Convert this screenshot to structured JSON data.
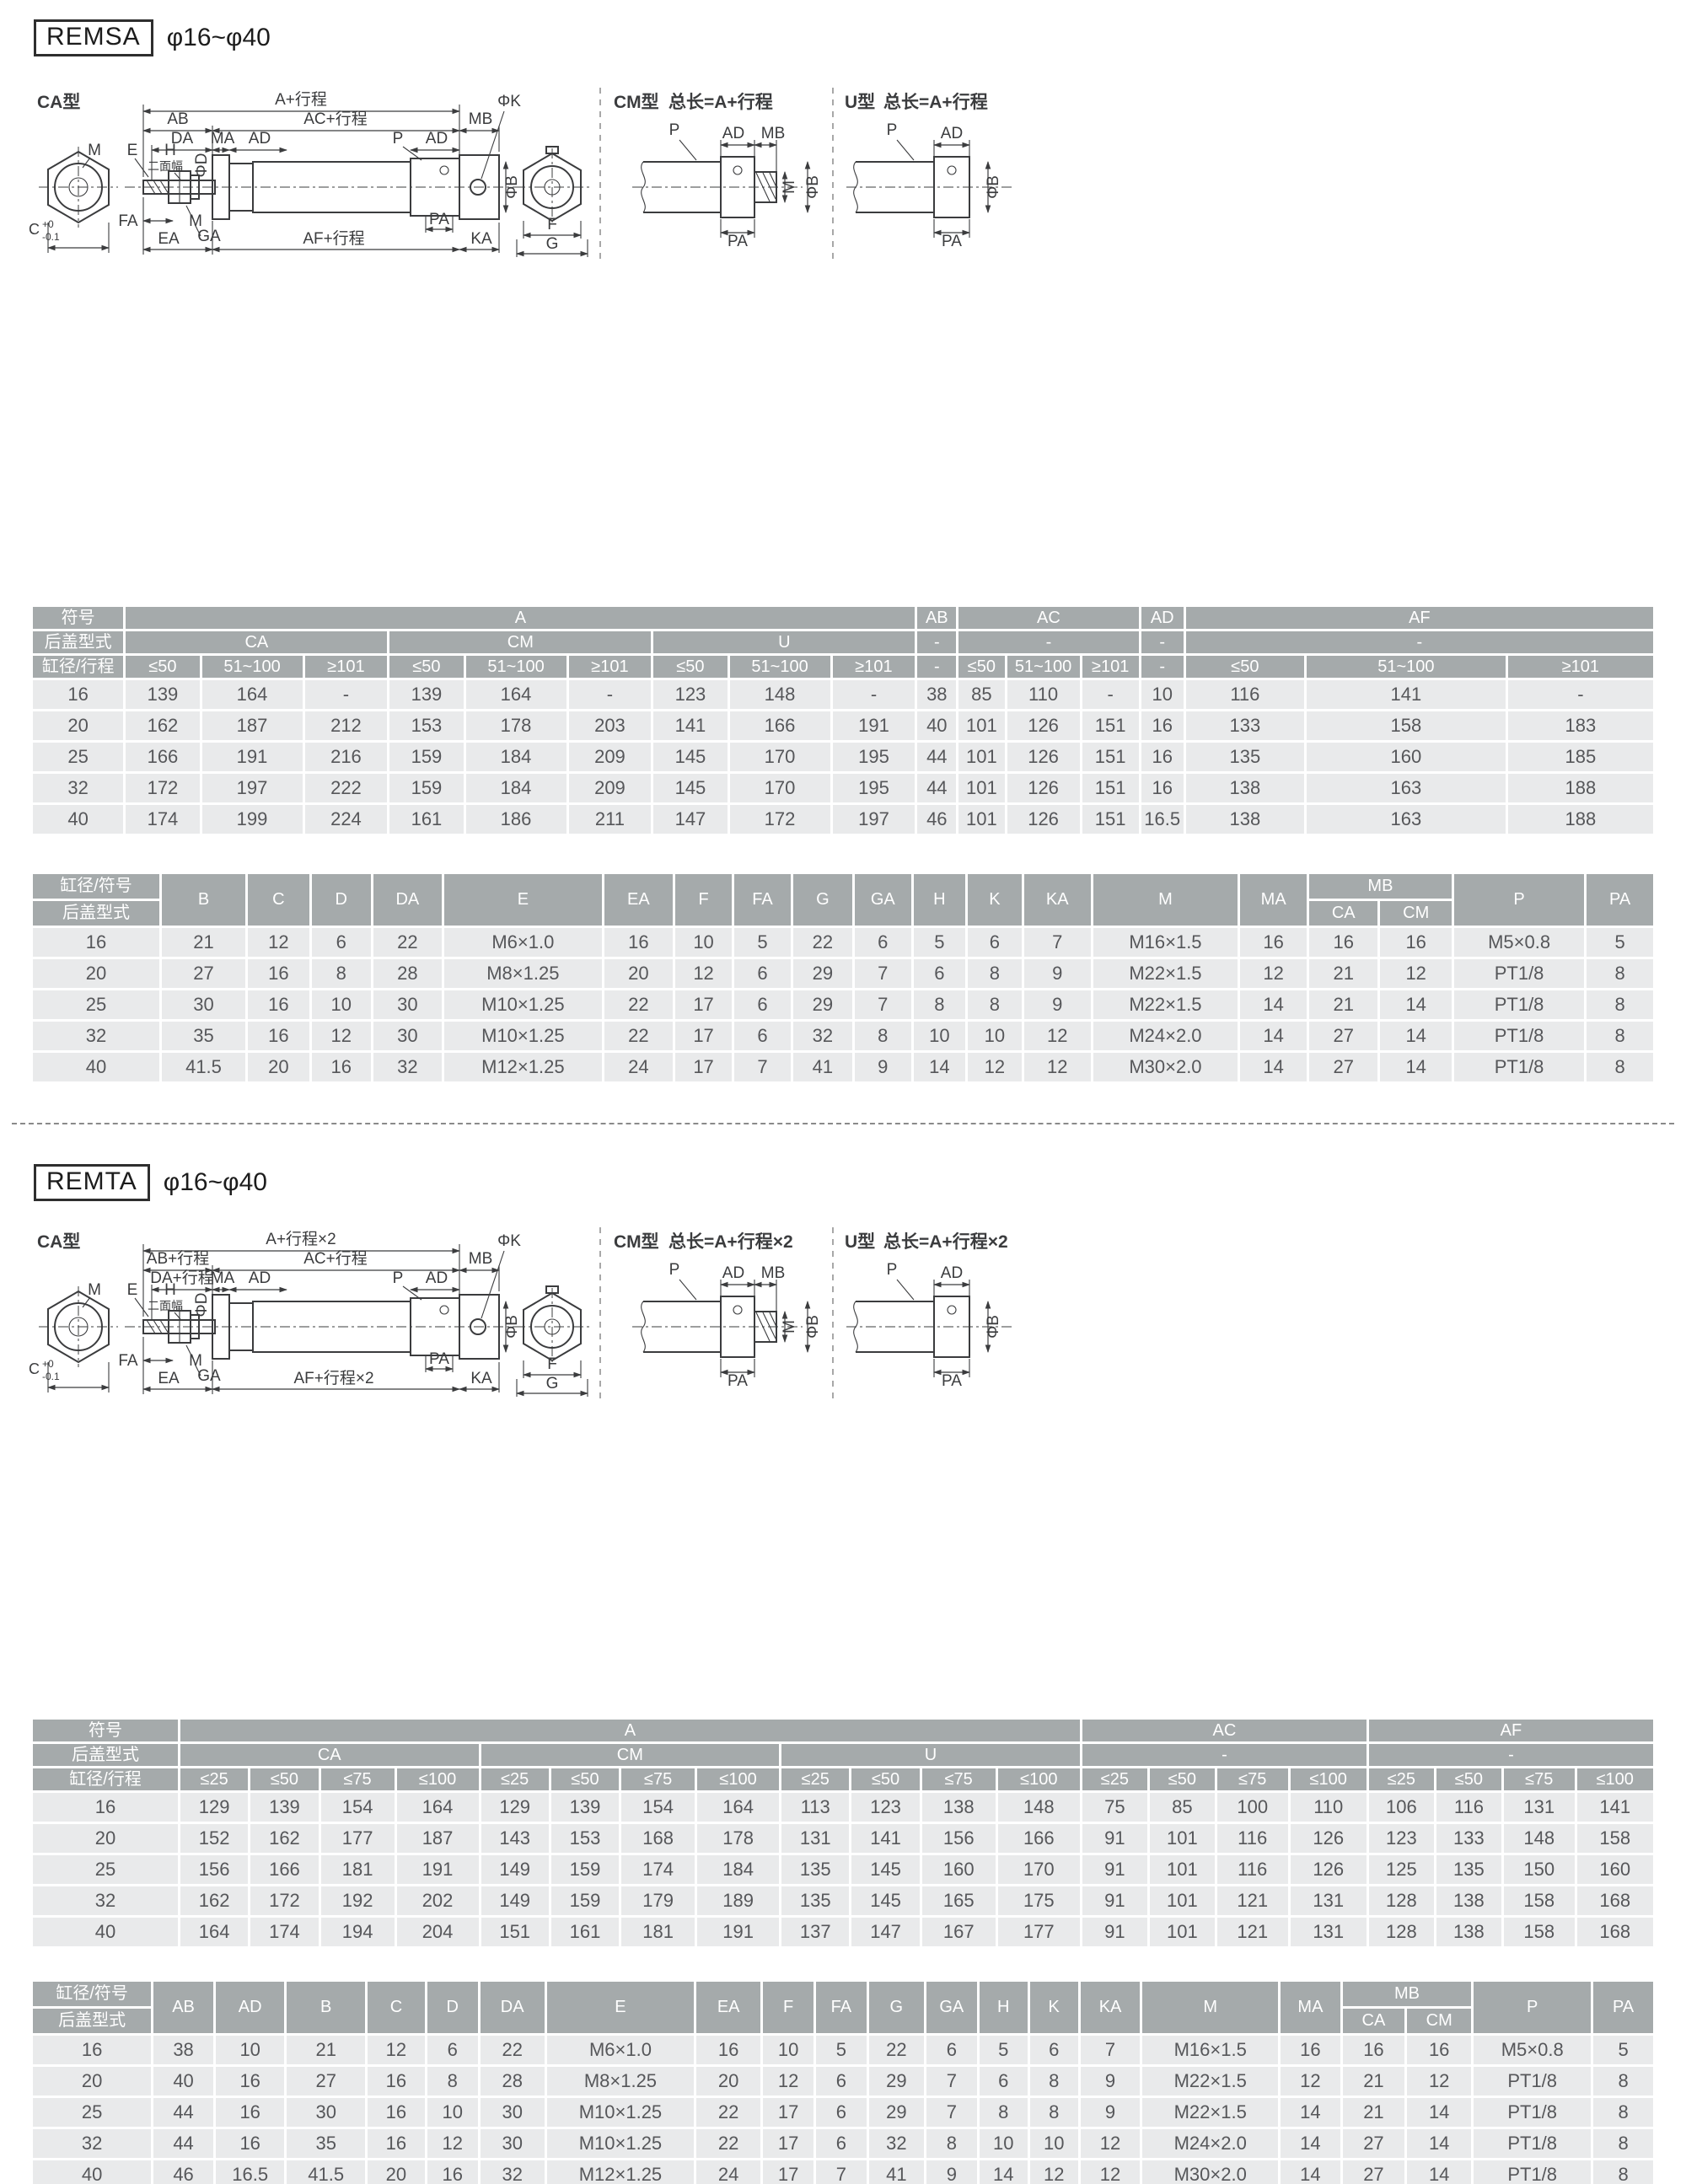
{
  "colors": {
    "header_bg": "#a5aaab",
    "row_bg": "#e9eaeb",
    "header_text": "#ffffff",
    "body_text": "#56575a",
    "line": "#3b3c3e"
  },
  "sections": [
    {
      "id": "remsa",
      "badge": "REMSA",
      "range": "φ16~φ40",
      "drawing": {
        "ca_title": "CA型",
        "cm_title": "CM型",
        "u_title": "U型",
        "cm_total": "总长=A+行程",
        "u_total": "总长=A+行程",
        "labels": {
          "a": "A+行程",
          "ab": "AB",
          "ac": "AC+行程",
          "mb": "MB",
          "phik": "ΦK",
          "da": "DA",
          "ma": "MA",
          "ad1": "AD",
          "p": "P",
          "ad2": "AD",
          "m_front": "M",
          "e": "E",
          "h": "H",
          "flats": "二面幅",
          "phid": "ΦD",
          "fa": "FA",
          "m_rod": "M",
          "ga": "GA",
          "ea": "EA",
          "af": "AF+行程",
          "pa": "PA",
          "ka": "KA",
          "phib": "ΦB",
          "c": "C",
          "c_sup": "+0",
          "c_sub": "-0.1",
          "f": "F",
          "g": "G",
          "cm_p": "P",
          "cm_ad": "AD",
          "cm_mb": "MB",
          "cm_m": "M",
          "cm_phib": "ΦB",
          "cm_pa": "PA",
          "u_p": "P",
          "u_ad": "AD",
          "u_phib": "ΦB",
          "u_pa": "PA"
        }
      },
      "table1": {
        "widths": [
          104,
          85,
          115,
          95,
          85,
          115,
          95,
          85,
          115,
          95,
          46,
          54,
          84,
          66,
          50,
          135,
          225,
          165
        ],
        "header": [
          [
            {
              "t": "符号"
            },
            {
              "t": "A",
              "cs": 9
            },
            {
              "t": "AB"
            },
            {
              "t": "AC",
              "cs": 3
            },
            {
              "t": "AD"
            },
            {
              "t": "AF",
              "cs": 3
            }
          ],
          [
            {
              "t": "后盖型式"
            },
            {
              "t": "CA",
              "cs": 3
            },
            {
              "t": "CM",
              "cs": 3
            },
            {
              "t": "U",
              "cs": 3
            },
            {
              "t": "-"
            },
            {
              "t": "-",
              "cs": 3
            },
            {
              "t": "-"
            },
            {
              "t": "-",
              "cs": 3
            }
          ],
          [
            {
              "t": "缸径/行程"
            },
            {
              "t": "≤50"
            },
            {
              "t": "51~100"
            },
            {
              "t": "≥101"
            },
            {
              "t": "≤50"
            },
            {
              "t": "51~100"
            },
            {
              "t": "≥101"
            },
            {
              "t": "≤50"
            },
            {
              "t": "51~100"
            },
            {
              "t": "≥101"
            },
            {
              "t": "-"
            },
            {
              "t": "≤50"
            },
            {
              "t": "51~100"
            },
            {
              "t": "≥101"
            },
            {
              "t": "-"
            },
            {
              "t": "≤50"
            },
            {
              "t": "51~100"
            },
            {
              "t": "≥101"
            }
          ]
        ],
        "rows": [
          [
            "16",
            139,
            164,
            "-",
            139,
            164,
            "-",
            123,
            148,
            "-",
            38,
            85,
            110,
            "-",
            10,
            116,
            141,
            "-"
          ],
          [
            "20",
            162,
            187,
            212,
            153,
            178,
            203,
            141,
            166,
            191,
            40,
            101,
            126,
            151,
            16,
            133,
            158,
            183
          ],
          [
            "25",
            166,
            191,
            216,
            159,
            184,
            209,
            145,
            170,
            195,
            44,
            101,
            126,
            151,
            16,
            135,
            160,
            185
          ],
          [
            "32",
            172,
            197,
            222,
            159,
            184,
            209,
            145,
            170,
            195,
            44,
            101,
            126,
            151,
            16,
            138,
            163,
            188
          ],
          [
            "40",
            174,
            199,
            224,
            161,
            186,
            211,
            147,
            172,
            197,
            46,
            101,
            126,
            151,
            16.5,
            138,
            163,
            188
          ]
        ]
      },
      "table2": {
        "widths": [
          105,
          70,
          52,
          50,
          58,
          130,
          58,
          48,
          48,
          50,
          48,
          44,
          46,
          56,
          120,
          56,
          58,
          60,
          108,
          56
        ],
        "header": [
          [
            {
              "split": [
                "缸径/符号",
                "后盖型式"
              ],
              "rs": 2
            },
            {
              "t": "B",
              "rs": 2
            },
            {
              "t": "C",
              "rs": 2
            },
            {
              "t": "D",
              "rs": 2
            },
            {
              "t": "DA",
              "rs": 2
            },
            {
              "t": "E",
              "rs": 2
            },
            {
              "t": "EA",
              "rs": 2
            },
            {
              "t": "F",
              "rs": 2
            },
            {
              "t": "FA",
              "rs": 2
            },
            {
              "t": "G",
              "rs": 2
            },
            {
              "t": "GA",
              "rs": 2
            },
            {
              "t": "H",
              "rs": 2
            },
            {
              "t": "K",
              "rs": 2
            },
            {
              "t": "KA",
              "rs": 2
            },
            {
              "t": "M",
              "rs": 2
            },
            {
              "t": "MA",
              "rs": 2
            },
            {
              "t": "MB",
              "cs": 2
            },
            {
              "t": "P",
              "rs": 2
            },
            {
              "t": "PA",
              "rs": 2
            }
          ],
          [
            {
              "t": "CA"
            },
            {
              "t": "CM"
            }
          ]
        ],
        "rows": [
          [
            "16",
            21,
            12,
            6,
            22,
            "M6×1.0",
            16,
            10,
            5,
            22,
            6,
            5,
            6,
            7,
            "M16×1.5",
            16,
            16,
            16,
            "M5×0.8",
            5
          ],
          [
            "20",
            27,
            16,
            8,
            28,
            "M8×1.25",
            20,
            12,
            6,
            29,
            7,
            6,
            8,
            9,
            "M22×1.5",
            12,
            21,
            12,
            "PT1/8",
            8
          ],
          [
            "25",
            30,
            16,
            10,
            30,
            "M10×1.25",
            22,
            17,
            6,
            29,
            7,
            8,
            8,
            9,
            "M22×1.5",
            14,
            21,
            14,
            "PT1/8",
            8
          ],
          [
            "32",
            35,
            16,
            12,
            30,
            "M10×1.25",
            22,
            17,
            6,
            32,
            8,
            10,
            10,
            12,
            "M24×2.0",
            14,
            27,
            14,
            "PT1/8",
            8
          ],
          [
            "40",
            41.5,
            20,
            16,
            32,
            "M12×1.25",
            24,
            17,
            7,
            41,
            9,
            14,
            12,
            12,
            "M30×2.0",
            14,
            27,
            14,
            "PT1/8",
            8
          ]
        ]
      }
    },
    {
      "id": "remta",
      "badge": "REMTA",
      "range": "φ16~φ40",
      "drawing": {
        "ca_title": "CA型",
        "cm_title": "CM型",
        "u_title": "U型",
        "cm_total": "总长=A+行程×2",
        "u_total": "总长=A+行程×2",
        "labels": {
          "a": "A+行程×2",
          "ab": "AB+行程",
          "ac": "AC+行程",
          "mb": "MB",
          "phik": "ΦK",
          "da": "DA+行程",
          "ma": "MA",
          "ad1": "AD",
          "p": "P",
          "ad2": "AD",
          "m_front": "M",
          "e": "E",
          "h": "H",
          "flats": "二面幅",
          "phid": "ΦD",
          "fa": "FA",
          "m_rod": "M",
          "ga": "GA",
          "ea": "EA",
          "af": "AF+行程×2",
          "pa": "PA",
          "ka": "KA",
          "phib": "ΦB",
          "c": "C",
          "c_sup": "+0",
          "c_sub": "-0.1",
          "f": "F",
          "g": "G",
          "cm_p": "P",
          "cm_ad": "AD",
          "cm_mb": "MB",
          "cm_m": "M",
          "cm_phib": "ΦB",
          "cm_pa": "PA",
          "u_p": "P",
          "u_ad": "AD",
          "u_phib": "ΦB",
          "u_pa": "PA"
        }
      },
      "table1": {
        "widths": [
          105,
          50,
          50,
          54,
          60,
          50,
          50,
          54,
          60,
          50,
          50,
          54,
          60,
          48,
          48,
          52,
          56,
          48,
          48,
          52,
          56
        ],
        "header": [
          [
            {
              "t": "符号"
            },
            {
              "t": "A",
              "cs": 12
            },
            {
              "t": "AC",
              "cs": 4
            },
            {
              "t": "AF",
              "cs": 4
            }
          ],
          [
            {
              "t": "后盖型式"
            },
            {
              "t": "CA",
              "cs": 4
            },
            {
              "t": "CM",
              "cs": 4
            },
            {
              "t": "U",
              "cs": 4
            },
            {
              "t": "-",
              "cs": 4
            },
            {
              "t": "-",
              "cs": 4
            }
          ],
          [
            {
              "t": "缸径/行程"
            },
            {
              "t": "≤25"
            },
            {
              "t": "≤50"
            },
            {
              "t": "≤75"
            },
            {
              "t": "≤100"
            },
            {
              "t": "≤25"
            },
            {
              "t": "≤50"
            },
            {
              "t": "≤75"
            },
            {
              "t": "≤100"
            },
            {
              "t": "≤25"
            },
            {
              "t": "≤50"
            },
            {
              "t": "≤75"
            },
            {
              "t": "≤100"
            },
            {
              "t": "≤25"
            },
            {
              "t": "≤50"
            },
            {
              "t": "≤75"
            },
            {
              "t": "≤100"
            },
            {
              "t": "≤25"
            },
            {
              "t": "≤50"
            },
            {
              "t": "≤75"
            },
            {
              "t": "≤100"
            }
          ]
        ],
        "rows": [
          [
            "16",
            129,
            139,
            154,
            164,
            129,
            139,
            154,
            164,
            113,
            123,
            138,
            148,
            75,
            85,
            100,
            110,
            106,
            116,
            131,
            141
          ],
          [
            "20",
            152,
            162,
            177,
            187,
            143,
            153,
            168,
            178,
            131,
            141,
            156,
            166,
            91,
            101,
            116,
            126,
            123,
            133,
            148,
            158
          ],
          [
            "25",
            156,
            166,
            181,
            191,
            149,
            159,
            174,
            184,
            135,
            145,
            160,
            170,
            91,
            101,
            116,
            126,
            125,
            135,
            150,
            160
          ],
          [
            "32",
            162,
            172,
            192,
            202,
            149,
            159,
            179,
            189,
            135,
            145,
            165,
            175,
            91,
            101,
            121,
            131,
            128,
            138,
            158,
            168
          ],
          [
            "40",
            164,
            174,
            194,
            204,
            151,
            161,
            181,
            191,
            137,
            147,
            167,
            177,
            91,
            101,
            121,
            131,
            128,
            138,
            158,
            168
          ]
        ]
      },
      "table2": {
        "widths": [
          105,
          54,
          62,
          70,
          52,
          46,
          58,
          130,
          58,
          46,
          46,
          50,
          46,
          44,
          44,
          54,
          120,
          54,
          56,
          58,
          104,
          54
        ],
        "header": [
          [
            {
              "split": [
                "缸径/符号",
                "后盖型式"
              ],
              "rs": 2
            },
            {
              "t": "AB",
              "rs": 2
            },
            {
              "t": "AD",
              "rs": 2
            },
            {
              "t": "B",
              "rs": 2
            },
            {
              "t": "C",
              "rs": 2
            },
            {
              "t": "D",
              "rs": 2
            },
            {
              "t": "DA",
              "rs": 2
            },
            {
              "t": "E",
              "rs": 2
            },
            {
              "t": "EA",
              "rs": 2
            },
            {
              "t": "F",
              "rs": 2
            },
            {
              "t": "FA",
              "rs": 2
            },
            {
              "t": "G",
              "rs": 2
            },
            {
              "t": "GA",
              "rs": 2
            },
            {
              "t": "H",
              "rs": 2
            },
            {
              "t": "K",
              "rs": 2
            },
            {
              "t": "KA",
              "rs": 2
            },
            {
              "t": "M",
              "rs": 2
            },
            {
              "t": "MA",
              "rs": 2
            },
            {
              "t": "MB",
              "cs": 2
            },
            {
              "t": "P",
              "rs": 2
            },
            {
              "t": "PA",
              "rs": 2
            }
          ],
          [
            {
              "t": "CA"
            },
            {
              "t": "CM"
            }
          ]
        ],
        "rows": [
          [
            "16",
            38,
            10,
            21,
            12,
            6,
            22,
            "M6×1.0",
            16,
            10,
            5,
            22,
            6,
            5,
            6,
            7,
            "M16×1.5",
            16,
            16,
            16,
            "M5×0.8",
            5
          ],
          [
            "20",
            40,
            16,
            27,
            16,
            8,
            28,
            "M8×1.25",
            20,
            12,
            6,
            29,
            7,
            6,
            8,
            9,
            "M22×1.5",
            12,
            21,
            12,
            "PT1/8",
            8
          ],
          [
            "25",
            44,
            16,
            30,
            16,
            10,
            30,
            "M10×1.25",
            22,
            17,
            6,
            29,
            7,
            8,
            8,
            9,
            "M22×1.5",
            14,
            21,
            14,
            "PT1/8",
            8
          ],
          [
            "32",
            44,
            16,
            35,
            16,
            12,
            30,
            "M10×1.25",
            22,
            17,
            6,
            32,
            8,
            10,
            10,
            12,
            "M24×2.0",
            14,
            27,
            14,
            "PT1/8",
            8
          ],
          [
            "40",
            46,
            16.5,
            41.5,
            20,
            16,
            32,
            "M12×1.25",
            24,
            17,
            7,
            41,
            9,
            14,
            12,
            12,
            "M30×2.0",
            14,
            27,
            14,
            "PT1/8",
            8
          ]
        ]
      }
    }
  ]
}
